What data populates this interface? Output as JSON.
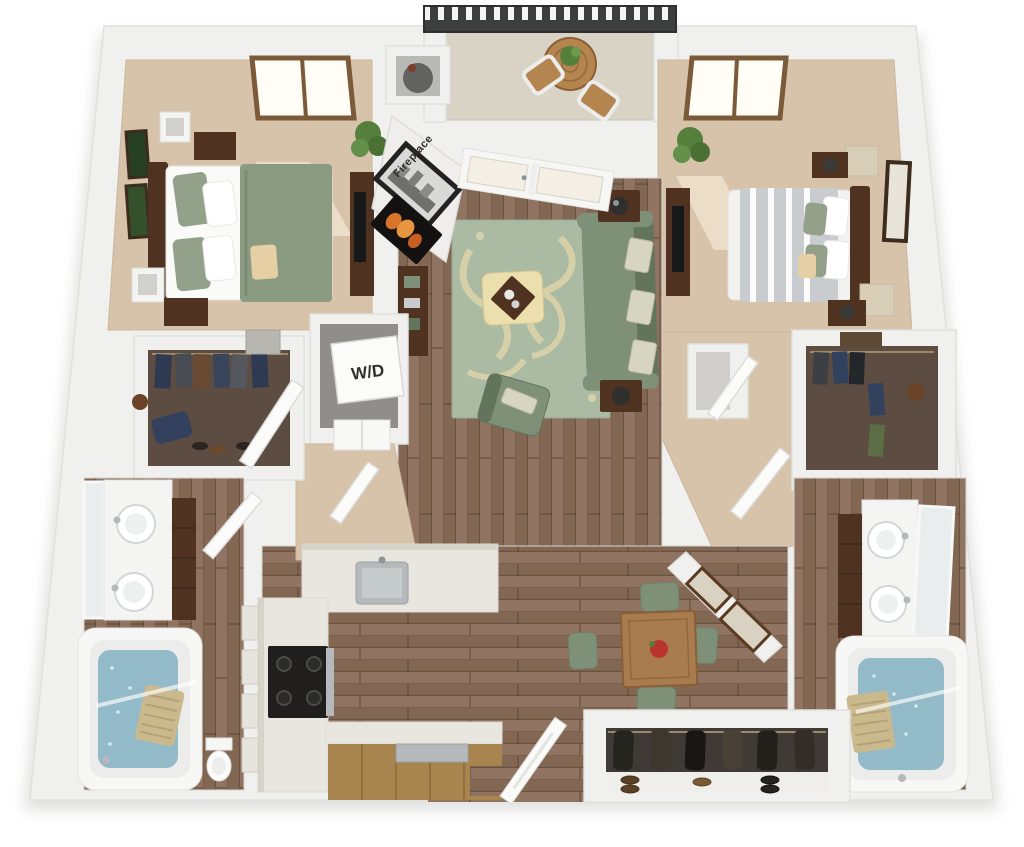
{
  "labels": {
    "washer_dryer": "W/D",
    "fireplace": "Fireplace"
  },
  "palette": {
    "wall": "#f0f0ee",
    "wall_line": "#e0e0dd",
    "carpet": "#d7c3a9",
    "accent": "#c3ae93",
    "wood_floor": "#8a6d58",
    "wood_line": "#6b523f",
    "closet_floor": "#5c4c41",
    "tile": "#d8d3c5",
    "rail": "#3c3f3e",
    "wood_dark": "#4f3320",
    "wood_mid": "#a87c4f",
    "sage": "#7e9077",
    "sage_dark": "#62755c",
    "rug": "#abbaa2",
    "rug_pattern": "#ded4ab",
    "cream": "#ecdfae",
    "water": "#92bac8",
    "counter": "#e8e6df",
    "cabinet": "#a8854f",
    "steel": "#b5b9bb",
    "black": "#1f1f1d",
    "leaf": "#55803c",
    "mirror": "#e9edee",
    "glass": "#f3efe4",
    "red": "#b9342e"
  }
}
